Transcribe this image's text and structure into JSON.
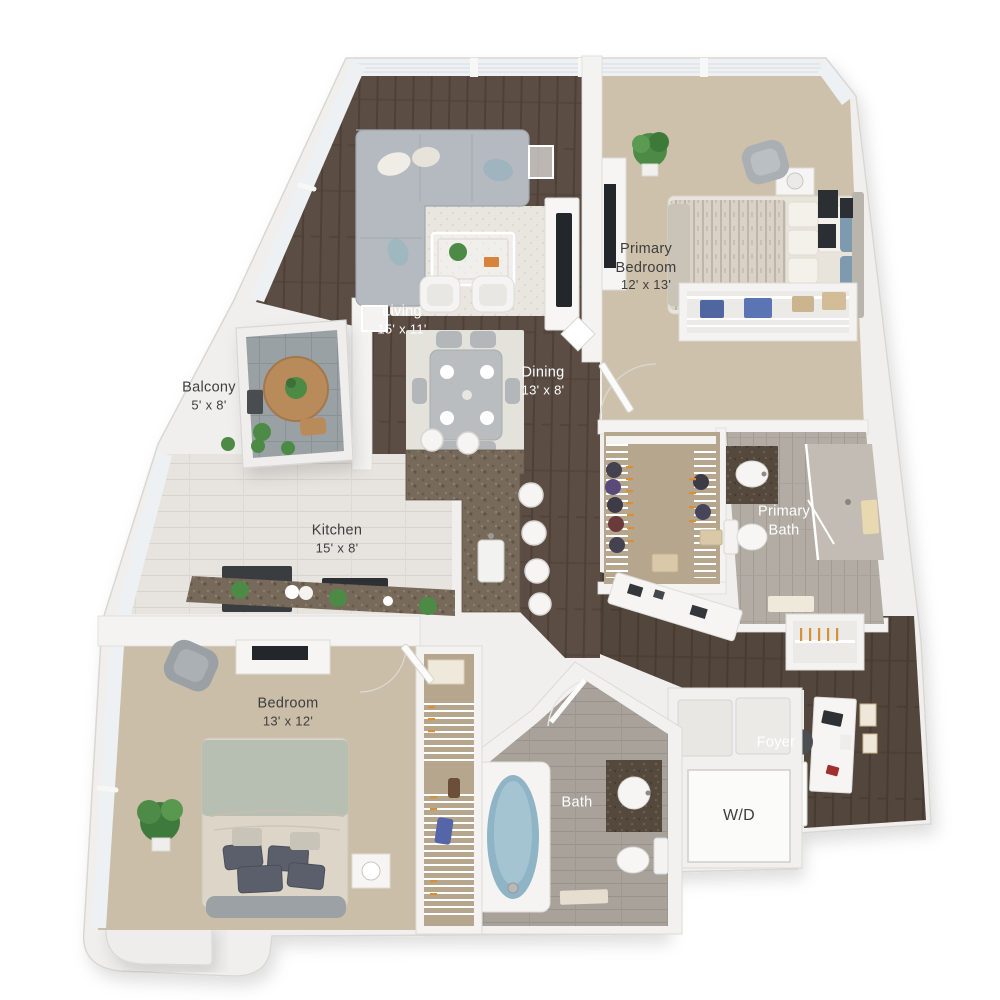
{
  "floor_plan": {
    "labels": {
      "balcony": {
        "title": "Balcony",
        "dims": "5' x 8'"
      },
      "living": {
        "title": "Living",
        "dims": "15' x 11'"
      },
      "dining": {
        "title": "Dining",
        "dims": "13' x 8'"
      },
      "primary_bedroom": {
        "line1": "Primary",
        "line2": "Bedroom",
        "dims": "12' x 13'"
      },
      "kitchen": {
        "title": "Kitchen",
        "dims": "15' x 8'"
      },
      "primary_bath": {
        "line1": "Primary",
        "line2": "Bath"
      },
      "bedroom": {
        "title": "Bedroom",
        "dims": "13' x 12'"
      },
      "bath": {
        "title": "Bath"
      },
      "foyer": {
        "title": "Foyer"
      },
      "washer_dryer": {
        "title": "W/D"
      }
    },
    "colors": {
      "wall": "#f0efed",
      "wood_floor": "#5b4d44",
      "carpet": "#cdc1ab",
      "kitchen_tile": "#e7e4df",
      "bath_tile": "#a8a29b",
      "counter_granite": "#776a5b",
      "tub_water": "#8fb4c6",
      "plant_green": "#4c8a46",
      "accent_blue": "#7e9aae",
      "hanger_orange": "#d88f35",
      "label_dark": "#3e3e3e",
      "label_light": "#ffffff"
    }
  }
}
